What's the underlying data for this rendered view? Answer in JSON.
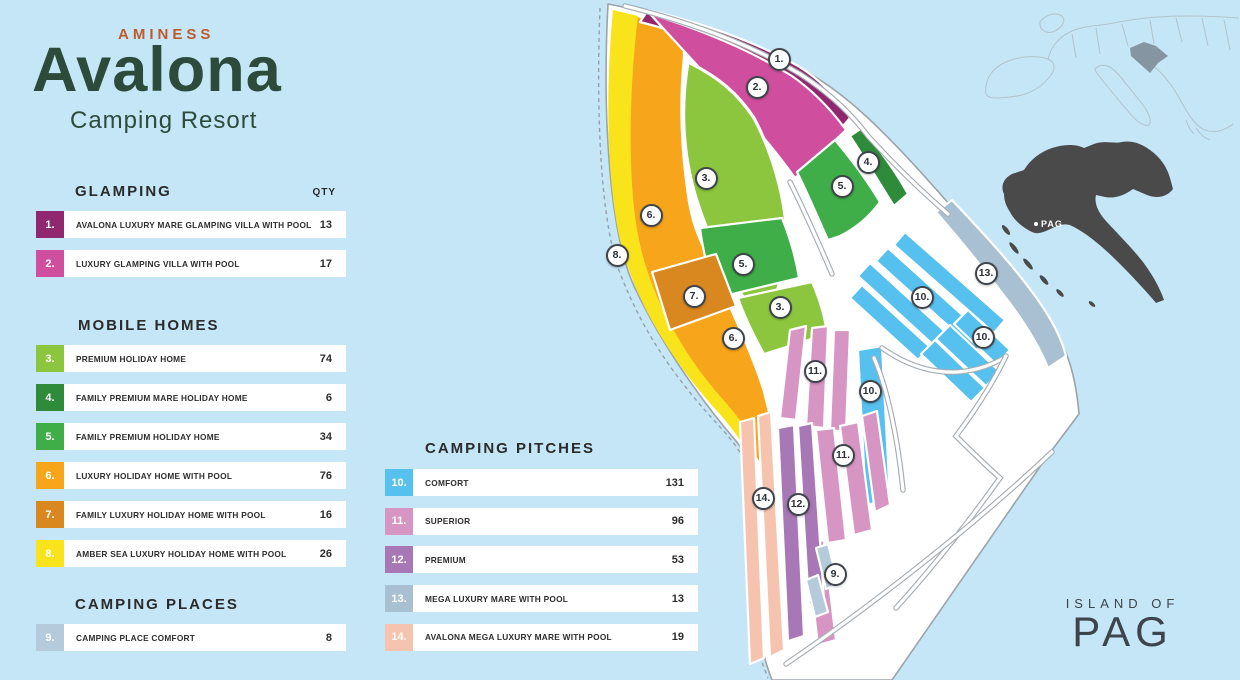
{
  "logo": {
    "brand": "AMINESS",
    "name": "Avalona",
    "subtitle": "Camping Resort"
  },
  "colors": {
    "sea": "#c5e6f7",
    "land": "#ffffff",
    "brand_orange": "#c05a2b",
    "brand_green": "#2d4b3b",
    "ink": "#2d2d2d",
    "island_text": "#3d444c",
    "croatia": "#4a4a4a",
    "europe_line": "#b3c2cb",
    "europe_croatia": "#8695a2"
  },
  "palette": {
    "1": "#91286f",
    "2": "#cf4f9e",
    "3": "#8cc63e",
    "4": "#2e8b3a",
    "5": "#3fae49",
    "6": "#f7a51b",
    "7": "#d9881f",
    "8": "#f9e41c",
    "9": "#b5cbdb",
    "10": "#56c0ee",
    "11": "#d795c4",
    "12": "#a877b5",
    "13": "#a9c0d3",
    "14": "#f6c3ae"
  },
  "legend": {
    "qty_header": "QTY",
    "sections": {
      "glamping": {
        "title": "GLAMPING",
        "items": [
          {
            "key": "1",
            "num": "1.",
            "label": "AVALONA LUXURY MARE GLAMPING VILLA WITH POOL",
            "qty": "13"
          },
          {
            "key": "2",
            "num": "2.",
            "label": "LUXURY GLAMPING VILLA WITH POOL",
            "qty": "17"
          }
        ]
      },
      "mobile_homes": {
        "title": "MOBILE HOMES",
        "items": [
          {
            "key": "3",
            "num": "3.",
            "label": "PREMIUM HOLIDAY HOME",
            "qty": "74"
          },
          {
            "key": "4",
            "num": "4.",
            "label": "FAMILY PREMIUM MARE HOLIDAY HOME",
            "qty": "6"
          },
          {
            "key": "5",
            "num": "5.",
            "label": "FAMILY PREMIUM HOLIDAY HOME",
            "qty": "34"
          },
          {
            "key": "6",
            "num": "6.",
            "label": "LUXURY HOLIDAY HOME WITH POOL",
            "qty": "76"
          },
          {
            "key": "7",
            "num": "7.",
            "label": "FAMILY LUXURY HOLIDAY HOME WITH POOL",
            "qty": "16"
          },
          {
            "key": "8",
            "num": "8.",
            "label": "AMBER SEA LUXURY HOLIDAY HOME WITH POOL",
            "qty": "26"
          }
        ]
      },
      "camping_places": {
        "title": "CAMPING PLACES",
        "items": [
          {
            "key": "9",
            "num": "9.",
            "label": "CAMPING PLACE COMFORT",
            "qty": "8"
          }
        ]
      },
      "camping_pitches": {
        "title": "CAMPING PITCHES",
        "items": [
          {
            "key": "10",
            "num": "10.",
            "label": "COMFORT",
            "qty": "131"
          },
          {
            "key": "11",
            "num": "11.",
            "label": "SUPERIOR",
            "qty": "96"
          },
          {
            "key": "12",
            "num": "12.",
            "label": "PREMIUM",
            "qty": "53"
          },
          {
            "key": "13",
            "num": "13.",
            "label": "MEGA LUXURY MARE WITH POOL",
            "qty": "13"
          },
          {
            "key": "14",
            "num": "14.",
            "label": "AVALONA MEGA LUXURY MARE WITH POOL",
            "qty": "19"
          }
        ]
      }
    }
  },
  "map": {
    "pag_label": "PAG",
    "island_of": "ISLAND OF",
    "island_name": "PAG",
    "markers": [
      {
        "label": "1.",
        "x": 779,
        "y": 59
      },
      {
        "label": "2.",
        "x": 757,
        "y": 87
      },
      {
        "label": "3.",
        "x": 706,
        "y": 178
      },
      {
        "label": "4.",
        "x": 868,
        "y": 162
      },
      {
        "label": "5.",
        "x": 842,
        "y": 186
      },
      {
        "label": "6.",
        "x": 651,
        "y": 215
      },
      {
        "label": "8.",
        "x": 617,
        "y": 255
      },
      {
        "label": "5.",
        "x": 743,
        "y": 264
      },
      {
        "label": "13.",
        "x": 986,
        "y": 273
      },
      {
        "label": "7.",
        "x": 694,
        "y": 296
      },
      {
        "label": "10.",
        "x": 922,
        "y": 297
      },
      {
        "label": "3.",
        "x": 780,
        "y": 307
      },
      {
        "label": "10.",
        "x": 983,
        "y": 337
      },
      {
        "label": "6.",
        "x": 733,
        "y": 338
      },
      {
        "label": "11.",
        "x": 815,
        "y": 371
      },
      {
        "label": "10.",
        "x": 870,
        "y": 391
      },
      {
        "label": "11.",
        "x": 843,
        "y": 455
      },
      {
        "label": "14.",
        "x": 763,
        "y": 498
      },
      {
        "label": "12.",
        "x": 798,
        "y": 504
      },
      {
        "label": "9.",
        "x": 835,
        "y": 574
      }
    ]
  }
}
